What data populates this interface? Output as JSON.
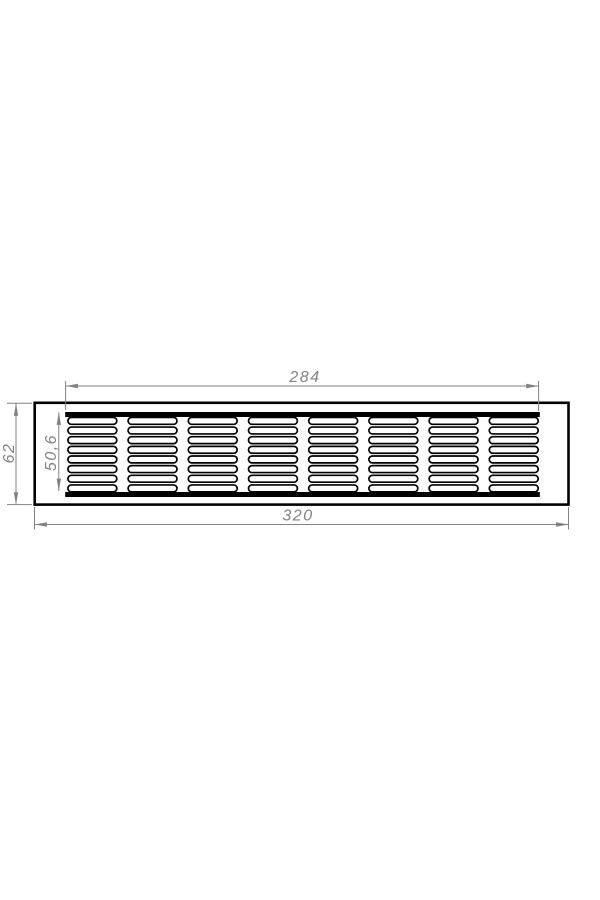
{
  "colors": {
    "part_outline": "#000000",
    "dimension": "#828282",
    "background": "#ffffff"
  },
  "dimension_labels": {
    "slot_field_width": "284",
    "overall_width": "320",
    "overall_height": "62",
    "slot_field_height": "50,6"
  },
  "grille": {
    "slot_columns": 8,
    "slot_rows": 8
  }
}
